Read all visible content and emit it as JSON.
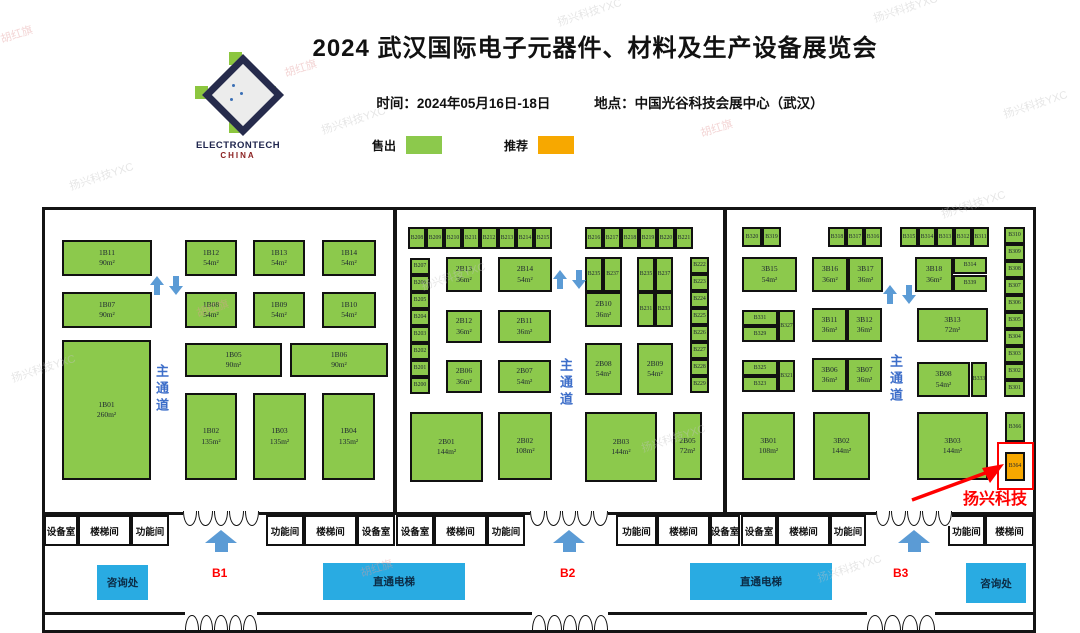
{
  "header": {
    "title": "2024 武汉国际电子元器件、材料及生产设备展览会",
    "time": "时间：2024年05月16日-18日",
    "location": "地点：中国光谷科技会展中心（武汉）",
    "logo_line1": "ELECTRONTECH",
    "logo_line2": "CHINA"
  },
  "legend": {
    "sold": "售出",
    "recommended": "推荐"
  },
  "colors": {
    "sold": "#8CC94C",
    "recommended": "#F7A800",
    "elevator": "#29ABE2",
    "aisle_text": "#3D6EC9",
    "arrow": "#5B9BD5",
    "gate_label": "#FF0000",
    "highlight": "#FF0000"
  },
  "plan": {
    "aisle_label": "主通道",
    "highlight": {
      "company": "扬兴科技",
      "booth": "B364"
    },
    "room_band": {
      "y": 515,
      "h": 31
    },
    "rooms": [
      {
        "label": "设备室",
        "x": 44,
        "w": 34
      },
      {
        "label": "楼梯间",
        "x": 78,
        "w": 53
      },
      {
        "label": "功能间",
        "x": 131,
        "w": 38
      },
      {
        "label": "功能间",
        "x": 266,
        "w": 38
      },
      {
        "label": "楼梯间",
        "x": 304,
        "w": 53
      },
      {
        "label": "设备室",
        "x": 357,
        "w": 38
      },
      {
        "label": "设备室",
        "x": 396,
        "w": 38
      },
      {
        "label": "楼梯间",
        "x": 434,
        "w": 53
      },
      {
        "label": "功能间",
        "x": 487,
        "w": 38
      },
      {
        "label": "功能间",
        "x": 616,
        "w": 41
      },
      {
        "label": "楼梯间",
        "x": 657,
        "w": 53
      },
      {
        "label": "设备室",
        "x": 710,
        "w": 30
      },
      {
        "label": "设备室",
        "x": 741,
        "w": 36
      },
      {
        "label": "楼梯间",
        "x": 777,
        "w": 53
      },
      {
        "label": "功能间",
        "x": 830,
        "w": 36
      },
      {
        "label": "功能间",
        "x": 948,
        "w": 37
      },
      {
        "label": "楼梯间",
        "x": 985,
        "w": 49
      }
    ],
    "top_gates": [
      {
        "x": 183,
        "w": 76,
        "cx": 221
      },
      {
        "x": 530,
        "w": 78,
        "cx": 569
      },
      {
        "x": 876,
        "w": 76,
        "cx": 914
      }
    ],
    "bottom_gates": [
      {
        "x": 185,
        "w": 72
      },
      {
        "x": 532,
        "w": 76
      },
      {
        "x": 867,
        "w": 68
      }
    ],
    "corridor": [
      {
        "kind": "info",
        "label": "咨询处",
        "x": 97,
        "y": 565,
        "w": 51,
        "h": 35
      },
      {
        "kind": "gate",
        "label": "B1",
        "x": 212,
        "y": 566
      },
      {
        "kind": "elevator",
        "label": "直通电梯",
        "x": 323,
        "y": 563,
        "w": 142,
        "h": 37
      },
      {
        "kind": "gate",
        "label": "B2",
        "x": 560,
        "y": 566
      },
      {
        "kind": "elevator",
        "label": "直通电梯",
        "x": 690,
        "y": 563,
        "w": 142,
        "h": 37
      },
      {
        "kind": "gate",
        "label": "B3",
        "x": 893,
        "y": 566
      },
      {
        "kind": "info",
        "label": "咨询处",
        "x": 966,
        "y": 563,
        "w": 60,
        "h": 40
      }
    ],
    "aisle_positions": [
      {
        "x": 152,
        "y": 364
      },
      {
        "x": 556,
        "y": 358
      },
      {
        "x": 886,
        "y": 354
      }
    ],
    "arrow_pairs": [
      {
        "x": 150,
        "y": 276
      },
      {
        "x": 553,
        "y": 270
      },
      {
        "x": 883,
        "y": 285
      }
    ],
    "booths": [
      {
        "id": "1B11",
        "area": "90m²",
        "x": 62,
        "y": 240,
        "w": 90,
        "h": 36
      },
      {
        "id": "1B12",
        "area": "54m²",
        "x": 185,
        "y": 240,
        "w": 52,
        "h": 36
      },
      {
        "id": "1B13",
        "area": "54m²",
        "x": 253,
        "y": 240,
        "w": 52,
        "h": 36
      },
      {
        "id": "1B14",
        "area": "54m²",
        "x": 322,
        "y": 240,
        "w": 54,
        "h": 36
      },
      {
        "id": "1B07",
        "area": "90m²",
        "x": 62,
        "y": 292,
        "w": 90,
        "h": 36
      },
      {
        "id": "1B08",
        "area": "54m²",
        "x": 185,
        "y": 292,
        "w": 52,
        "h": 36
      },
      {
        "id": "1B09",
        "area": "54m²",
        "x": 253,
        "y": 292,
        "w": 52,
        "h": 36
      },
      {
        "id": "1B10",
        "area": "54m²",
        "x": 322,
        "y": 292,
        "w": 54,
        "h": 36
      },
      {
        "id": "1B01",
        "area": "260m²",
        "x": 62,
        "y": 340,
        "w": 89,
        "h": 140
      },
      {
        "id": "1B05",
        "area": "90m²",
        "x": 185,
        "y": 343,
        "w": 97,
        "h": 34
      },
      {
        "id": "1B06",
        "area": "90m²",
        "x": 290,
        "y": 343,
        "w": 98,
        "h": 34
      },
      {
        "id": "1B02",
        "area": "135m²",
        "x": 185,
        "y": 393,
        "w": 52,
        "h": 87
      },
      {
        "id": "1B03",
        "area": "135m²",
        "x": 253,
        "y": 393,
        "w": 53,
        "h": 87
      },
      {
        "id": "1B04",
        "area": "135m²",
        "x": 322,
        "y": 393,
        "w": 53,
        "h": 87
      },
      {
        "id": "B208",
        "x": 408,
        "y": 227,
        "w": 18,
        "h": 22
      },
      {
        "id": "B209",
        "x": 426,
        "y": 227,
        "w": 18,
        "h": 22
      },
      {
        "id": "B210",
        "x": 444,
        "y": 227,
        "w": 18,
        "h": 22
      },
      {
        "id": "B211",
        "x": 462,
        "y": 227,
        "w": 18,
        "h": 22
      },
      {
        "id": "B212",
        "x": 480,
        "y": 227,
        "w": 18,
        "h": 22
      },
      {
        "id": "B213",
        "x": 498,
        "y": 227,
        "w": 18,
        "h": 22
      },
      {
        "id": "B214",
        "x": 516,
        "y": 227,
        "w": 18,
        "h": 22
      },
      {
        "id": "B215",
        "x": 534,
        "y": 227,
        "w": 18,
        "h": 22
      },
      {
        "id": "B216",
        "x": 585,
        "y": 227,
        "w": 18,
        "h": 22
      },
      {
        "id": "B217",
        "x": 603,
        "y": 227,
        "w": 18,
        "h": 22
      },
      {
        "id": "B218",
        "x": 621,
        "y": 227,
        "w": 18,
        "h": 22
      },
      {
        "id": "B219",
        "x": 639,
        "y": 227,
        "w": 18,
        "h": 22
      },
      {
        "id": "B220",
        "x": 657,
        "y": 227,
        "w": 18,
        "h": 22
      },
      {
        "id": "B221",
        "x": 675,
        "y": 227,
        "w": 18,
        "h": 22
      },
      {
        "id": "B207",
        "x": 410,
        "y": 258,
        "w": 20,
        "h": 17
      },
      {
        "id": "B206",
        "x": 410,
        "y": 275,
        "w": 20,
        "h": 17
      },
      {
        "id": "B205",
        "x": 410,
        "y": 292,
        "w": 20,
        "h": 17
      },
      {
        "id": "B204",
        "x": 410,
        "y": 309,
        "w": 20,
        "h": 17
      },
      {
        "id": "B203",
        "x": 410,
        "y": 326,
        "w": 20,
        "h": 17
      },
      {
        "id": "B202",
        "x": 410,
        "y": 343,
        "w": 20,
        "h": 17
      },
      {
        "id": "B201",
        "x": 410,
        "y": 360,
        "w": 20,
        "h": 17
      },
      {
        "id": "B200",
        "x": 410,
        "y": 377,
        "w": 20,
        "h": 17
      },
      {
        "id": "2B13",
        "area": "36m²",
        "x": 446,
        "y": 257,
        "w": 36,
        "h": 35
      },
      {
        "id": "2B14",
        "area": "54m²",
        "x": 498,
        "y": 257,
        "w": 54,
        "h": 35
      },
      {
        "id": "B235",
        "x": 585,
        "y": 257,
        "w": 18,
        "h": 35
      },
      {
        "id": "B237",
        "x": 603,
        "y": 257,
        "w": 19,
        "h": 35
      },
      {
        "id": "2B10",
        "area": "36m²",
        "x": 585,
        "y": 292,
        "w": 37,
        "h": 35
      },
      {
        "id": "B235",
        "x": 637,
        "y": 257,
        "w": 18,
        "h": 35
      },
      {
        "id": "B237",
        "x": 655,
        "y": 257,
        "w": 18,
        "h": 35
      },
      {
        "id": "B231",
        "x": 637,
        "y": 292,
        "w": 18,
        "h": 35
      },
      {
        "id": "B233",
        "x": 655,
        "y": 292,
        "w": 18,
        "h": 35
      },
      {
        "id": "2B12",
        "area": "36m²",
        "x": 446,
        "y": 310,
        "w": 36,
        "h": 33
      },
      {
        "id": "2B11",
        "area": "36m²",
        "x": 498,
        "y": 310,
        "w": 53,
        "h": 33
      },
      {
        "id": "2B06",
        "area": "36m²",
        "x": 446,
        "y": 360,
        "w": 36,
        "h": 33
      },
      {
        "id": "2B07",
        "area": "54m²",
        "x": 498,
        "y": 360,
        "w": 53,
        "h": 33
      },
      {
        "id": "2B08",
        "area": "54m²",
        "x": 585,
        "y": 343,
        "w": 37,
        "h": 52
      },
      {
        "id": "2B09",
        "area": "54m²",
        "x": 637,
        "y": 343,
        "w": 36,
        "h": 52
      },
      {
        "id": "B222",
        "x": 690,
        "y": 257,
        "w": 19,
        "h": 17
      },
      {
        "id": "B223",
        "x": 690,
        "y": 274,
        "w": 19,
        "h": 17
      },
      {
        "id": "B224",
        "x": 690,
        "y": 291,
        "w": 19,
        "h": 17
      },
      {
        "id": "B225",
        "x": 690,
        "y": 308,
        "w": 19,
        "h": 17
      },
      {
        "id": "B226",
        "x": 690,
        "y": 325,
        "w": 19,
        "h": 17
      },
      {
        "id": "B227",
        "x": 690,
        "y": 342,
        "w": 19,
        "h": 17
      },
      {
        "id": "B228",
        "x": 690,
        "y": 359,
        "w": 19,
        "h": 17
      },
      {
        "id": "B229",
        "x": 690,
        "y": 376,
        "w": 19,
        "h": 17
      },
      {
        "id": "2B01",
        "area": "144m²",
        "x": 410,
        "y": 412,
        "w": 73,
        "h": 70
      },
      {
        "id": "2B02",
        "area": "108m²",
        "x": 498,
        "y": 412,
        "w": 54,
        "h": 68
      },
      {
        "id": "2B03",
        "area": "144m²",
        "x": 585,
        "y": 412,
        "w": 72,
        "h": 70
      },
      {
        "id": "2B05",
        "area": "72m²",
        "x": 673,
        "y": 412,
        "w": 29,
        "h": 68
      },
      {
        "id": "B320",
        "x": 742,
        "y": 227,
        "w": 20,
        "h": 20
      },
      {
        "id": "B319",
        "x": 762,
        "y": 227,
        "w": 19,
        "h": 20
      },
      {
        "id": "B318",
        "x": 828,
        "y": 227,
        "w": 18,
        "h": 20
      },
      {
        "id": "B317",
        "x": 846,
        "y": 227,
        "w": 18,
        "h": 20
      },
      {
        "id": "B316",
        "x": 864,
        "y": 227,
        "w": 18,
        "h": 20
      },
      {
        "id": "B315",
        "x": 900,
        "y": 227,
        "w": 18,
        "h": 20
      },
      {
        "id": "B314",
        "x": 918,
        "y": 227,
        "w": 18,
        "h": 20
      },
      {
        "id": "B313",
        "x": 936,
        "y": 227,
        "w": 18,
        "h": 20
      },
      {
        "id": "B312",
        "x": 954,
        "y": 227,
        "w": 18,
        "h": 20
      },
      {
        "id": "B311",
        "x": 972,
        "y": 227,
        "w": 17,
        "h": 20
      },
      {
        "id": "B310",
        "x": 1004,
        "y": 227,
        "w": 21,
        "h": 17
      },
      {
        "id": "B309",
        "x": 1004,
        "y": 244,
        "w": 21,
        "h": 17
      },
      {
        "id": "B308",
        "x": 1004,
        "y": 261,
        "w": 21,
        "h": 17
      },
      {
        "id": "B307",
        "x": 1004,
        "y": 278,
        "w": 21,
        "h": 17
      },
      {
        "id": "B306",
        "x": 1004,
        "y": 295,
        "w": 21,
        "h": 17
      },
      {
        "id": "B305",
        "x": 1004,
        "y": 312,
        "w": 21,
        "h": 17
      },
      {
        "id": "B304",
        "x": 1004,
        "y": 329,
        "w": 21,
        "h": 17
      },
      {
        "id": "B303",
        "x": 1004,
        "y": 346,
        "w": 21,
        "h": 17
      },
      {
        "id": "B302",
        "x": 1004,
        "y": 363,
        "w": 21,
        "h": 17
      },
      {
        "id": "B301",
        "x": 1004,
        "y": 380,
        "w": 21,
        "h": 17
      },
      {
        "id": "3B15",
        "area": "54m²",
        "x": 742,
        "y": 257,
        "w": 55,
        "h": 35
      },
      {
        "id": "3B16",
        "area": "36m²",
        "x": 812,
        "y": 257,
        "w": 36,
        "h": 35
      },
      {
        "id": "3B17",
        "area": "36m²",
        "x": 848,
        "y": 257,
        "w": 35,
        "h": 35
      },
      {
        "id": "3B18",
        "area": "36m²",
        "x": 915,
        "y": 257,
        "w": 38,
        "h": 35
      },
      {
        "id": "B314",
        "x": 953,
        "y": 257,
        "w": 34,
        "h": 17
      },
      {
        "id": "B339",
        "x": 953,
        "y": 275,
        "w": 34,
        "h": 17
      },
      {
        "id": "B331",
        "x": 742,
        "y": 310,
        "w": 36,
        "h": 16
      },
      {
        "id": "B329",
        "x": 742,
        "y": 326,
        "w": 36,
        "h": 16
      },
      {
        "id": "B327",
        "x": 778,
        "y": 310,
        "w": 17,
        "h": 32
      },
      {
        "id": "3B11",
        "area": "36m²",
        "x": 812,
        "y": 308,
        "w": 35,
        "h": 34
      },
      {
        "id": "3B12",
        "area": "36m²",
        "x": 847,
        "y": 308,
        "w": 35,
        "h": 34
      },
      {
        "id": "3B13",
        "area": "72m²",
        "x": 917,
        "y": 308,
        "w": 71,
        "h": 34
      },
      {
        "id": "B325",
        "x": 742,
        "y": 360,
        "w": 36,
        "h": 16
      },
      {
        "id": "B323",
        "x": 742,
        "y": 376,
        "w": 36,
        "h": 16
      },
      {
        "id": "B321",
        "x": 778,
        "y": 360,
        "w": 17,
        "h": 32
      },
      {
        "id": "3B06",
        "area": "36m²",
        "x": 812,
        "y": 358,
        "w": 35,
        "h": 34
      },
      {
        "id": "3B07",
        "area": "36m²",
        "x": 847,
        "y": 358,
        "w": 35,
        "h": 34
      },
      {
        "id": "3B08",
        "area": "54m²",
        "x": 917,
        "y": 362,
        "w": 53,
        "h": 35
      },
      {
        "id": "B333",
        "x": 971,
        "y": 362,
        "w": 16,
        "h": 35
      },
      {
        "id": "3B01",
        "area": "108m²",
        "x": 742,
        "y": 412,
        "w": 53,
        "h": 68
      },
      {
        "id": "3B02",
        "area": "144m²",
        "x": 813,
        "y": 412,
        "w": 57,
        "h": 68
      },
      {
        "id": "3B03",
        "area": "144m²",
        "x": 917,
        "y": 412,
        "w": 71,
        "h": 68
      },
      {
        "id": "B366",
        "x": 1005,
        "y": 412,
        "w": 20,
        "h": 30
      },
      {
        "id": "B364",
        "x": 1005,
        "y": 452,
        "w": 20,
        "h": 29,
        "rec": true
      }
    ]
  },
  "watermarks": [
    {
      "t": "胡红旗",
      "x": 0,
      "y": 26,
      "c": "#e39b9b"
    },
    {
      "t": "扬兴科技YXC",
      "x": 68,
      "y": 168,
      "c": "#c4c4c4"
    },
    {
      "t": "胡红旗",
      "x": 284,
      "y": 60,
      "c": "#e39b9b"
    },
    {
      "t": "扬兴科技YXC",
      "x": 320,
      "y": 112,
      "c": "#c4c4c4"
    },
    {
      "t": "扬兴科技YXC",
      "x": 556,
      "y": 4,
      "c": "#c4c4c4"
    },
    {
      "t": "扬兴科技YXC",
      "x": 872,
      "y": 0,
      "c": "#c4c4c4"
    },
    {
      "t": "胡红旗",
      "x": 700,
      "y": 120,
      "c": "#e39b9b"
    },
    {
      "t": "扬兴科技YXC",
      "x": 1002,
      "y": 96,
      "c": "#c4c4c4"
    },
    {
      "t": "扬兴科技YXC",
      "x": 10,
      "y": 360,
      "c": "#c4c4c4"
    },
    {
      "t": "胡红旗",
      "x": 196,
      "y": 300,
      "c": "#e39b9b"
    },
    {
      "t": "扬兴科技YXC",
      "x": 420,
      "y": 268,
      "c": "#c4c4c4"
    },
    {
      "t": "扬兴科技YXC",
      "x": 640,
      "y": 430,
      "c": "#c4c4c4"
    },
    {
      "t": "胡红旗",
      "x": 360,
      "y": 560,
      "c": "#e39b9b"
    },
    {
      "t": "扬兴科技YXC",
      "x": 816,
      "y": 560,
      "c": "#c4c4c4"
    },
    {
      "t": "扬兴科技YXC",
      "x": 940,
      "y": 196,
      "c": "#c4c4c4"
    }
  ]
}
